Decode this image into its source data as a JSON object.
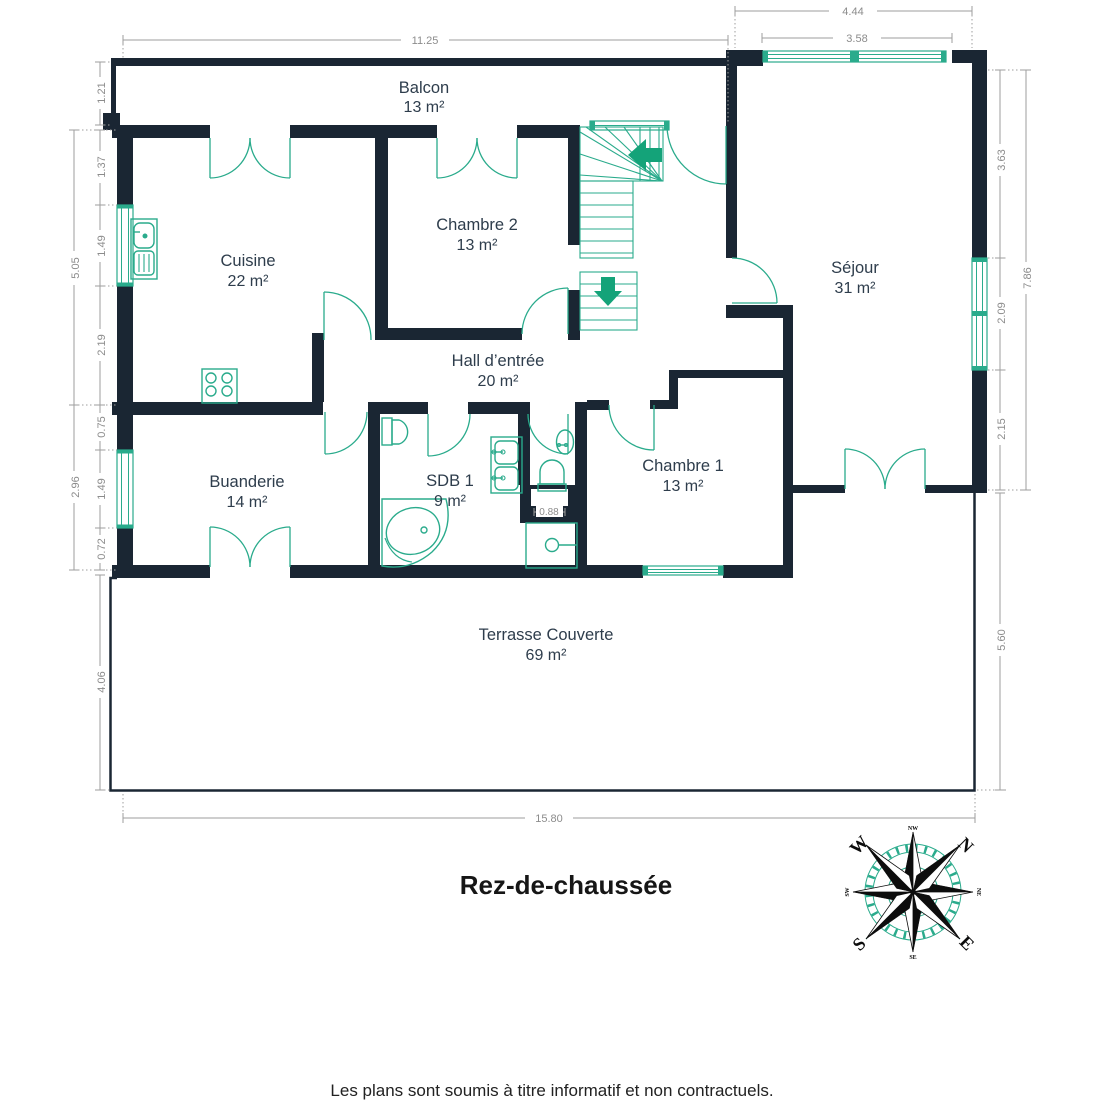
{
  "page": {
    "floor_label": "Rez-de-chaussée",
    "disclaimer": "Les plans sont soumis à titre informatif et non contractuels."
  },
  "rooms": [
    {
      "name": "Balcon",
      "area": "13 m²"
    },
    {
      "name": "Cuisine",
      "area": "22 m²"
    },
    {
      "name": "Chambre 2",
      "area": "13 m²"
    },
    {
      "name": "Séjour",
      "area": "31 m²"
    },
    {
      "name": "Hall d’entrée",
      "area": "20 m²"
    },
    {
      "name": "Buanderie",
      "area": "14 m²"
    },
    {
      "name": "SDB 1",
      "area": "9 m²"
    },
    {
      "name": "Chambre 1",
      "area": "13 m²"
    },
    {
      "name": "Terrasse Couverte",
      "area": "69 m²"
    }
  ],
  "dimensions": {
    "top_main": "11.25",
    "top_right_outer": "4.44",
    "top_right_inner": "3.58",
    "left_balcony": "1.21",
    "left_upper_total": "5.05",
    "left_upper_a": "1.37",
    "left_upper_b": "1.49",
    "left_upper_c": "2.19",
    "left_lower_total": "2.96",
    "left_lower_a": "0.75",
    "left_lower_b": "1.49",
    "left_lower_c": "0.72",
    "left_terrace": "4.06",
    "right_a": "3.63",
    "right_b": "2.09",
    "right_c": "2.15",
    "right_total": "7.86",
    "right_terrace": "5.60",
    "bottom_main": "15.80",
    "wc_niche": "0.88"
  },
  "compass": {
    "cardinals": {
      "west": "W",
      "north": "N",
      "south": "S",
      "east": "E"
    },
    "intercardinals": {
      "top": "NW",
      "right": "NE",
      "bottom": "SE",
      "left": "SW"
    }
  },
  "colors": {
    "wall": "#1a2633",
    "fixture": "#2aab8c",
    "accent": "#14a379",
    "dim": "#9e9e9e",
    "label": "#2e3d4c"
  }
}
